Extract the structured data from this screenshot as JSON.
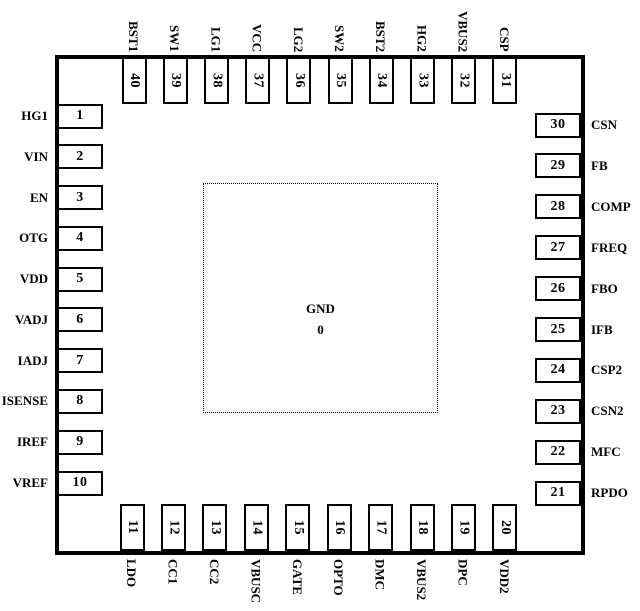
{
  "diagram_title": "IC package pinout diagram",
  "colors": {
    "ink": "#000000",
    "background": "#ffffff"
  },
  "chip": {
    "center_pad": {
      "label": "GND",
      "number": "0"
    },
    "left_pins": [
      {
        "num": "1",
        "name": "HG1"
      },
      {
        "num": "2",
        "name": "VIN"
      },
      {
        "num": "3",
        "name": "EN"
      },
      {
        "num": "4",
        "name": "OTG"
      },
      {
        "num": "5",
        "name": "VDD"
      },
      {
        "num": "6",
        "name": "VADJ"
      },
      {
        "num": "7",
        "name": "IADJ"
      },
      {
        "num": "8",
        "name": "ISENSE"
      },
      {
        "num": "9",
        "name": "IREF"
      },
      {
        "num": "10",
        "name": "VREF"
      }
    ],
    "right_pins": [
      {
        "num": "30",
        "name": "CSN"
      },
      {
        "num": "29",
        "name": "FB"
      },
      {
        "num": "28",
        "name": "COMP"
      },
      {
        "num": "27",
        "name": "FREQ"
      },
      {
        "num": "26",
        "name": "FBO"
      },
      {
        "num": "25",
        "name": "IFB"
      },
      {
        "num": "24",
        "name": "CSP2"
      },
      {
        "num": "23",
        "name": "CSN2"
      },
      {
        "num": "22",
        "name": "MFC"
      },
      {
        "num": "21",
        "name": "RPDO"
      }
    ],
    "top_pins": [
      {
        "num": "40",
        "name": "BST1"
      },
      {
        "num": "39",
        "name": "SW1"
      },
      {
        "num": "38",
        "name": "LG1"
      },
      {
        "num": "37",
        "name": "VCC"
      },
      {
        "num": "36",
        "name": "LG2"
      },
      {
        "num": "35",
        "name": "SW2"
      },
      {
        "num": "34",
        "name": "BST2"
      },
      {
        "num": "33",
        "name": "HG2"
      },
      {
        "num": "32",
        "name": "VBUS2"
      },
      {
        "num": "31",
        "name": "CSP"
      }
    ],
    "bottom_pins": [
      {
        "num": "11",
        "name": "LDO"
      },
      {
        "num": "12",
        "name": "CC1"
      },
      {
        "num": "13",
        "name": "CC2"
      },
      {
        "num": "14",
        "name": "VBUSC"
      },
      {
        "num": "15",
        "name": "GATE"
      },
      {
        "num": "16",
        "name": "OPTO"
      },
      {
        "num": "17",
        "name": "DMC"
      },
      {
        "num": "18",
        "name": "VBUS2"
      },
      {
        "num": "19",
        "name": "DPC"
      },
      {
        "num": "20",
        "name": "VDD2"
      }
    ]
  }
}
